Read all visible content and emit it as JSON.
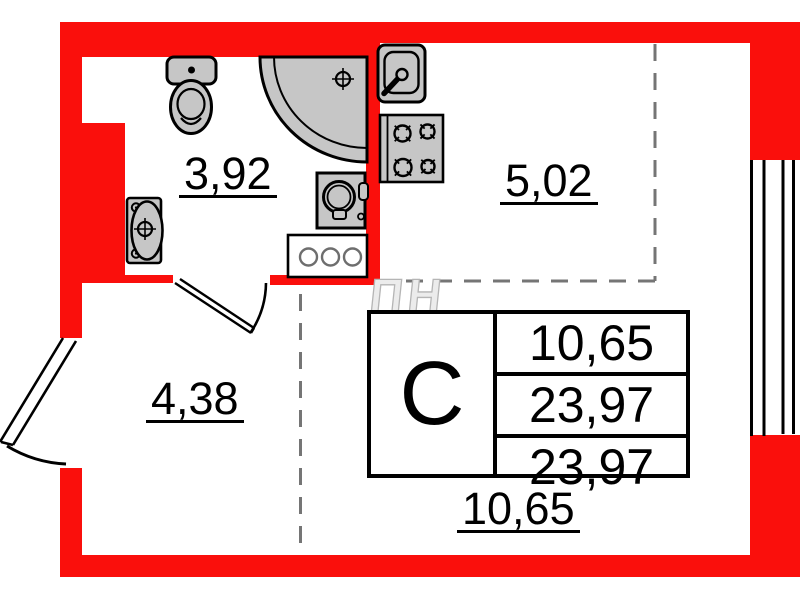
{
  "rooms": {
    "bathroom": {
      "area": "3,92"
    },
    "kitchen": {
      "area": "5,02"
    },
    "hallway": {
      "area": "4,38"
    },
    "living_room": {
      "area": "10,65"
    }
  },
  "info_table": {
    "type": "С",
    "row1": "10,65",
    "row2": "23,97",
    "row3": "23,97"
  },
  "watermark": "ПН",
  "colors": {
    "wall": "#FA0F0C",
    "fixture_fill": "#C6C6C6",
    "outline": "#000000",
    "zone_dash": "#757575"
  },
  "fixtures": [
    "toilet",
    "corner-shower",
    "washing-machine",
    "washbasin",
    "cabinet",
    "kitchen-sink",
    "stove",
    "window",
    "entrance-door",
    "bathroom-door"
  ]
}
